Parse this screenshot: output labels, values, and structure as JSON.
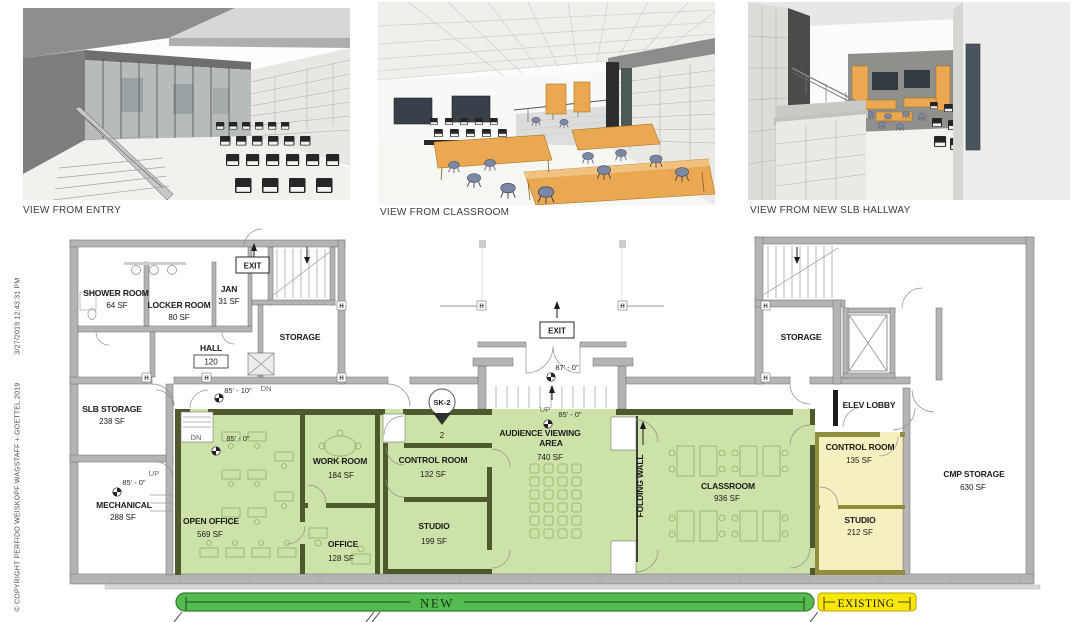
{
  "renderings": [
    {
      "caption": "VIEW FROM ENTRY"
    },
    {
      "caption": "VIEW FROM CLASSROOM"
    },
    {
      "caption": "VIEW FROM NEW SLB HALLWAY"
    }
  ],
  "copyright": {
    "notice": "© COPYRIGHT PERFIDO WEISKOPF WAGSTAFF + GOETTEL  2019",
    "timestamp": "3/27/2019 12:43:31 PM"
  },
  "plan": {
    "rooms": {
      "shower": {
        "name": "SHOWER ROOM",
        "area": "64 SF"
      },
      "locker": {
        "name": "LOCKER ROOM",
        "area": "80 SF"
      },
      "jan": {
        "name": "JAN",
        "area": "31 SF"
      },
      "hall": {
        "name": "HALL",
        "number": "120"
      },
      "storage_left": {
        "name": "STORAGE"
      },
      "slb": {
        "name": "SLB STORAGE",
        "area": "238 SF"
      },
      "mech": {
        "name": "MECHANICAL",
        "area": "288 SF"
      },
      "open_office": {
        "name": "OPEN OFFICE",
        "area": "569 SF"
      },
      "work": {
        "name": "WORK ROOM",
        "area": "184 SF"
      },
      "control_new": {
        "name": "CONTROL ROOM",
        "area": "132 SF"
      },
      "studio_new": {
        "name": "STUDIO",
        "area": "199 SF"
      },
      "office": {
        "name": "OFFICE",
        "area": "128 SF"
      },
      "audience": {
        "line1": "AUDIENCE VIEWING",
        "line2": "AREA",
        "area": "740 SF"
      },
      "classroom": {
        "name": "CLASSROOM",
        "area": "936 SF"
      },
      "storage_right": {
        "name": "STORAGE"
      },
      "elev_lobby": {
        "name": "ELEV LOBBY"
      },
      "control_existing": {
        "name": "CONTROL ROOM",
        "area": "135 SF"
      },
      "studio_existing": {
        "name": "STUDIO",
        "area": "212 SF"
      },
      "cmp": {
        "name": "CMP STORAGE",
        "area": "630 SF"
      }
    },
    "annotations": {
      "exit": "EXIT",
      "up": "UP",
      "dn": "DN",
      "h": "H",
      "folding_wall": "FOLDING WALL",
      "sk": {
        "label": "SK-2",
        "number": "2"
      },
      "dims": {
        "d85_10": "85' - 10\"",
        "d85_0": "85' - 0\"",
        "d87_0": "87' - 0\""
      }
    },
    "legend": {
      "new": "NEW",
      "existing": "EXISTING"
    },
    "colors": {
      "new_zone": "#cde2a8",
      "new_wall": "#4e5a2e",
      "existing_zone": "#f6efbf",
      "existing_zone_wall": "#8f8e3e",
      "wall_gray": "#b4b4b4",
      "new_bar": "#55ba50",
      "existing_bar": "#f8e707"
    }
  }
}
